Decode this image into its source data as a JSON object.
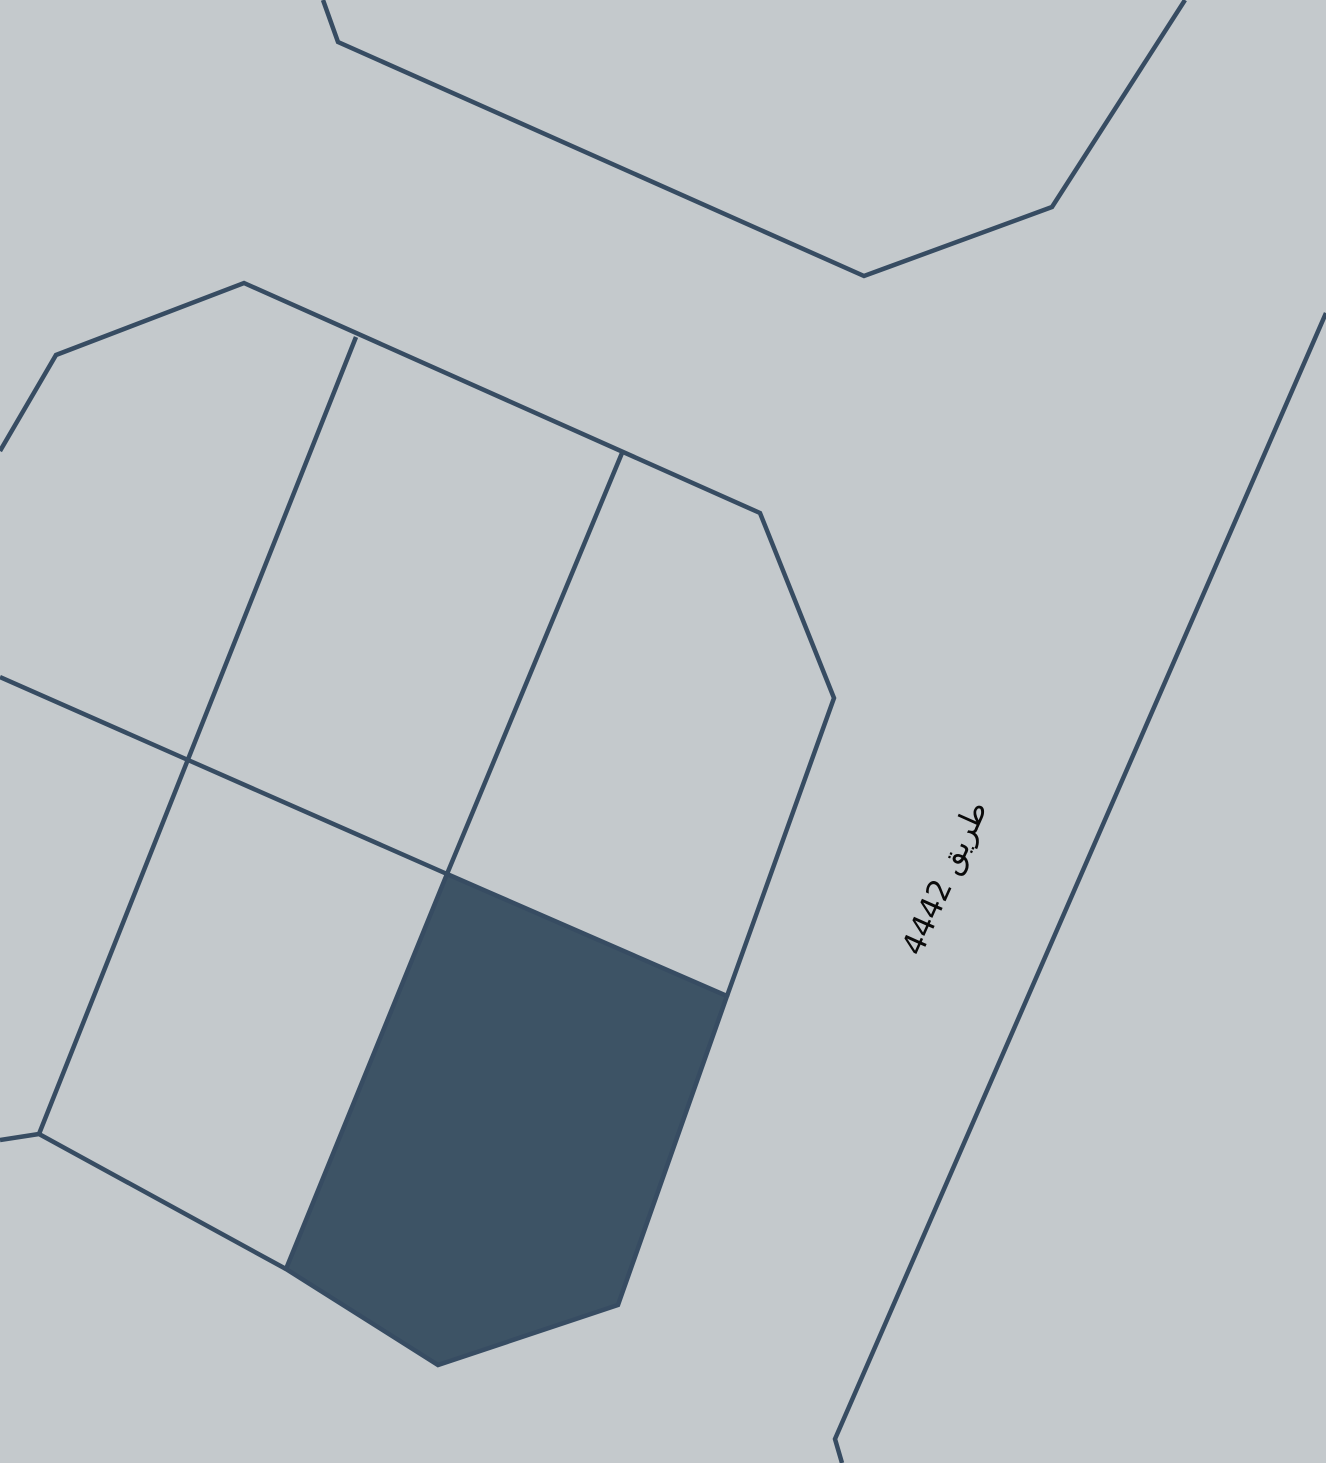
{
  "map": {
    "background_color": "#c4c9cc",
    "line_color": "#374c62",
    "line_width": 4.5,
    "selected_parcel_color": "#3d5365",
    "road_label": {
      "text": "طريق 4442",
      "color": "#0a0a0a"
    },
    "canvas": {
      "width": 1326,
      "height": 1463
    },
    "shapes": [
      {
        "name": "upper-parcel-outline",
        "type": "polyline",
        "filled": false,
        "interactable": false,
        "points": [
          [
            323,
            0
          ],
          [
            338,
            42
          ],
          [
            864,
            276
          ],
          [
            1052,
            207
          ],
          [
            1185,
            0
          ]
        ]
      },
      {
        "name": "road-right-edge",
        "type": "polyline",
        "filled": false,
        "interactable": false,
        "points": [
          [
            1326,
            313
          ],
          [
            835,
            1439
          ],
          [
            842,
            1463
          ]
        ]
      },
      {
        "name": "block-outer-boundary",
        "type": "polyline",
        "filled": false,
        "interactable": false,
        "points": [
          [
            0,
            451
          ],
          [
            56,
            355
          ],
          [
            244,
            283
          ],
          [
            760,
            513
          ],
          [
            834,
            698
          ],
          [
            727,
            996
          ]
        ]
      },
      {
        "name": "block-bottom-boundary",
        "type": "polyline",
        "filled": false,
        "interactable": false,
        "points": [
          [
            0,
            1140
          ],
          [
            39,
            1134
          ],
          [
            286,
            1269
          ]
        ]
      },
      {
        "name": "parcel-divider-left",
        "type": "polyline",
        "filled": false,
        "interactable": false,
        "points": [
          [
            356,
            337
          ],
          [
            39,
            1134
          ]
        ]
      },
      {
        "name": "parcel-divider-right",
        "type": "polyline",
        "filled": false,
        "interactable": false,
        "points": [
          [
            622,
            453
          ],
          [
            447,
            874
          ]
        ]
      },
      {
        "name": "block-row-divider",
        "type": "polyline",
        "filled": false,
        "interactable": false,
        "points": [
          [
            0,
            677
          ],
          [
            188,
            760
          ],
          [
            447,
            874
          ]
        ]
      },
      {
        "name": "selected-parcel",
        "type": "polygon",
        "filled": true,
        "interactable": true,
        "points": [
          [
            447,
            874
          ],
          [
            727,
            996
          ],
          [
            618,
            1305
          ],
          [
            438,
            1365
          ],
          [
            286,
            1269
          ]
        ]
      }
    ]
  }
}
